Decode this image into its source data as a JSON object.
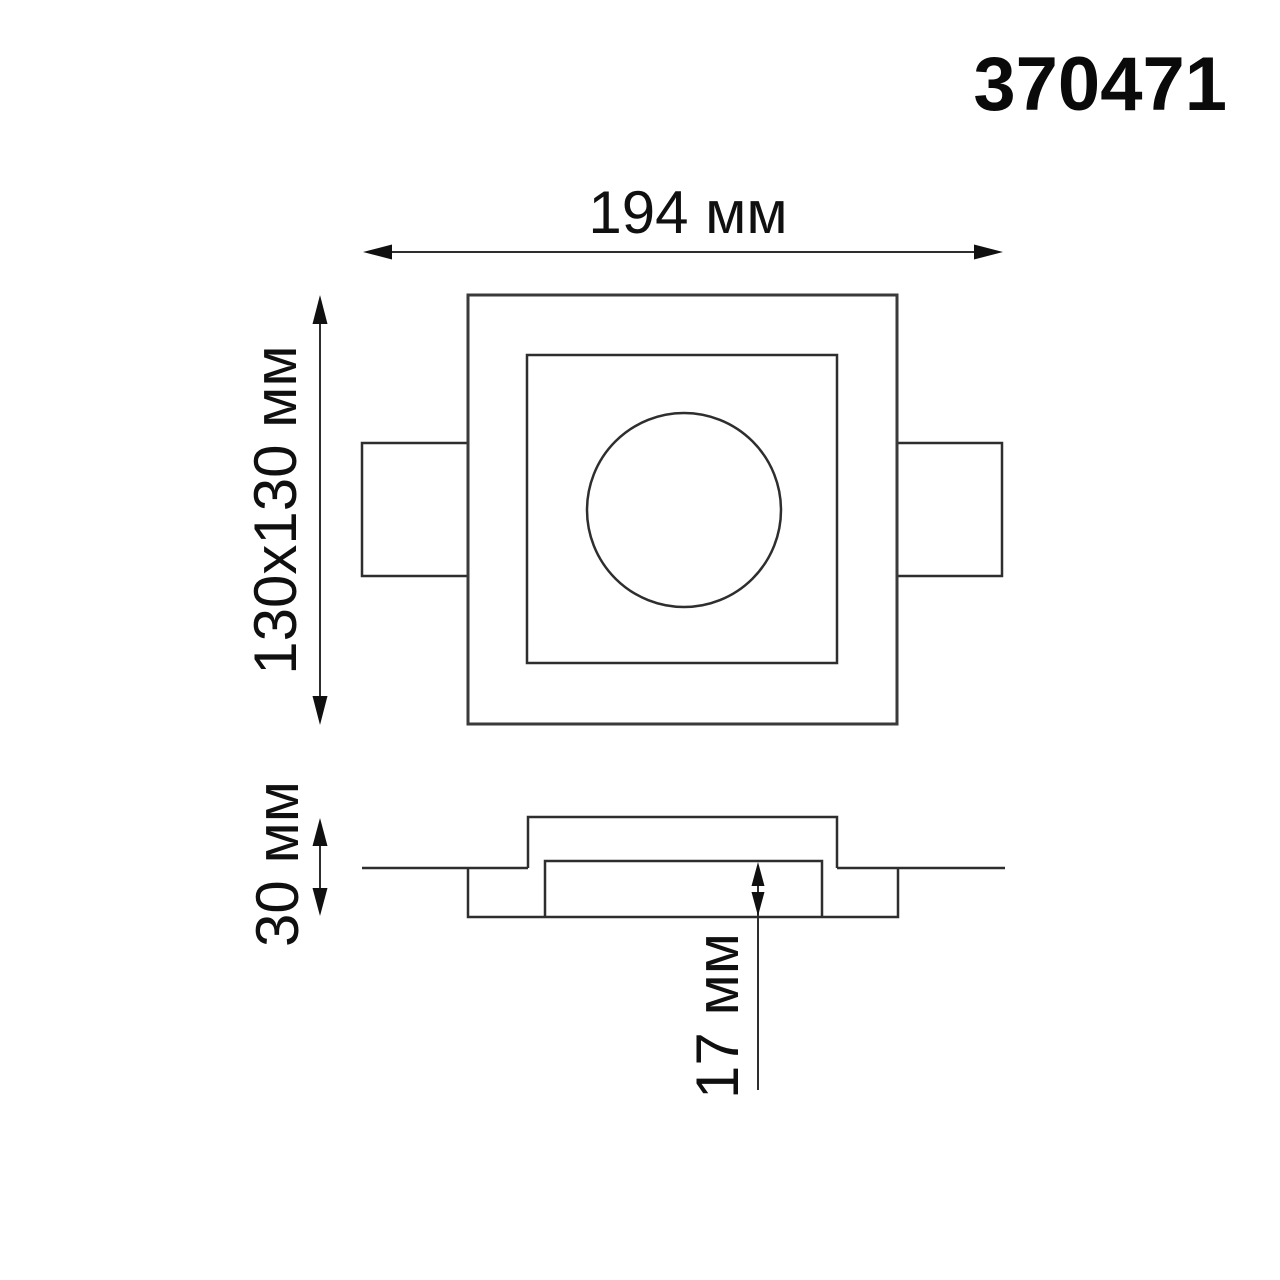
{
  "drawing": {
    "product_code": "370471",
    "top_view": {
      "width_label": "194 мм",
      "cutout_label": "130x130 мм"
    },
    "side_view": {
      "height_label": "30 мм",
      "depth_label": "17 мм"
    },
    "colors": {
      "line": "#3a3a3a",
      "text": "#101010",
      "background": "#ffffff"
    }
  }
}
